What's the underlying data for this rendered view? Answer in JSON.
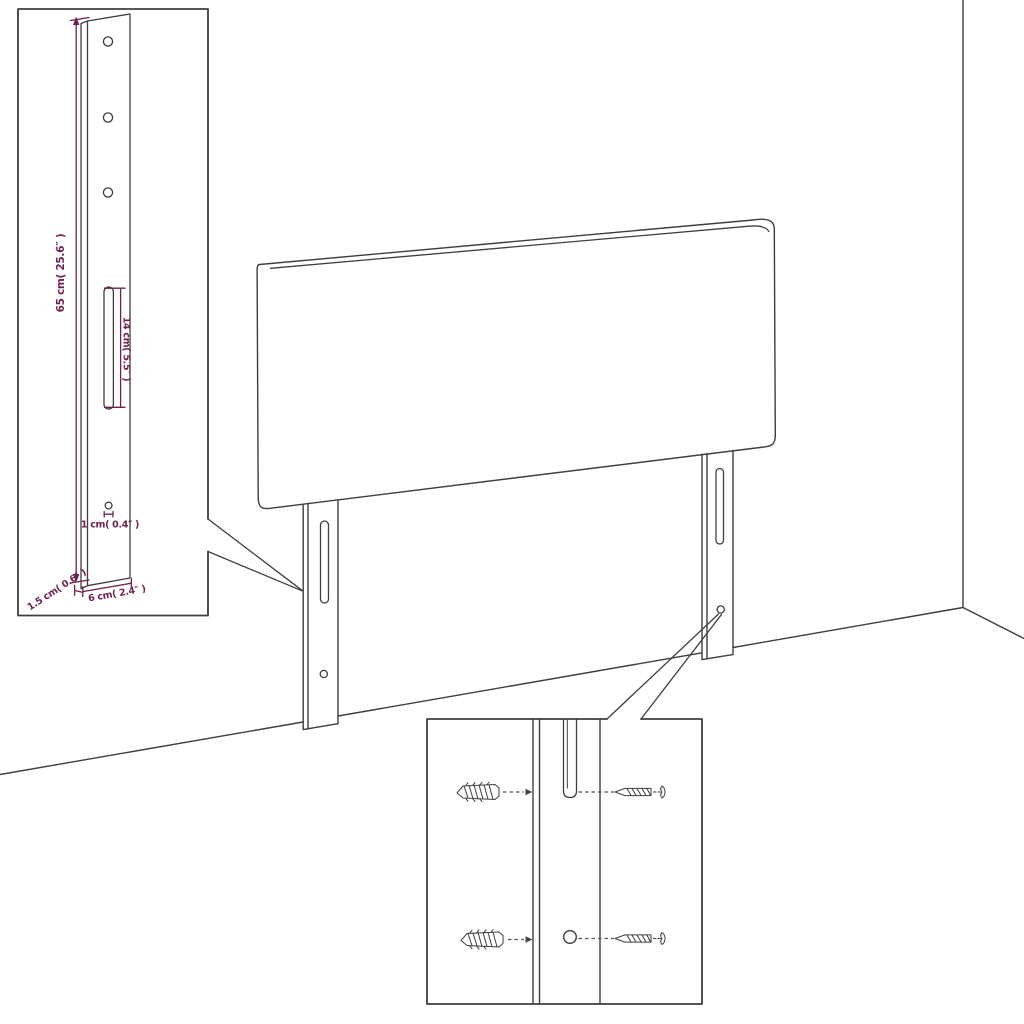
{
  "colors": {
    "background": "#ffffff",
    "line": "#3e3e3e",
    "dimension": "#702050"
  },
  "diagram": {
    "type": "product-assembly-dimension-diagram",
    "subject": "upholstered bed headboard with two slotted mounting legs shown against a room corner",
    "insets": {
      "leg_detail": "enlarged side view of mounting leg with three screw holes, adjustment slot and lower hole",
      "hardware_detail": "enlarged view of leg slot and hole with wall plugs and screws alignment"
    },
    "labels": {
      "height": "65 cm( 25.6″ )",
      "slot_height": "14 cm( 5.5″ )",
      "hole_diameter": "1 cm( 0.4″ )",
      "leg_depth": "1.5 cm( 0.6″ )",
      "leg_width": "6 cm( 2.4″ )"
    }
  }
}
